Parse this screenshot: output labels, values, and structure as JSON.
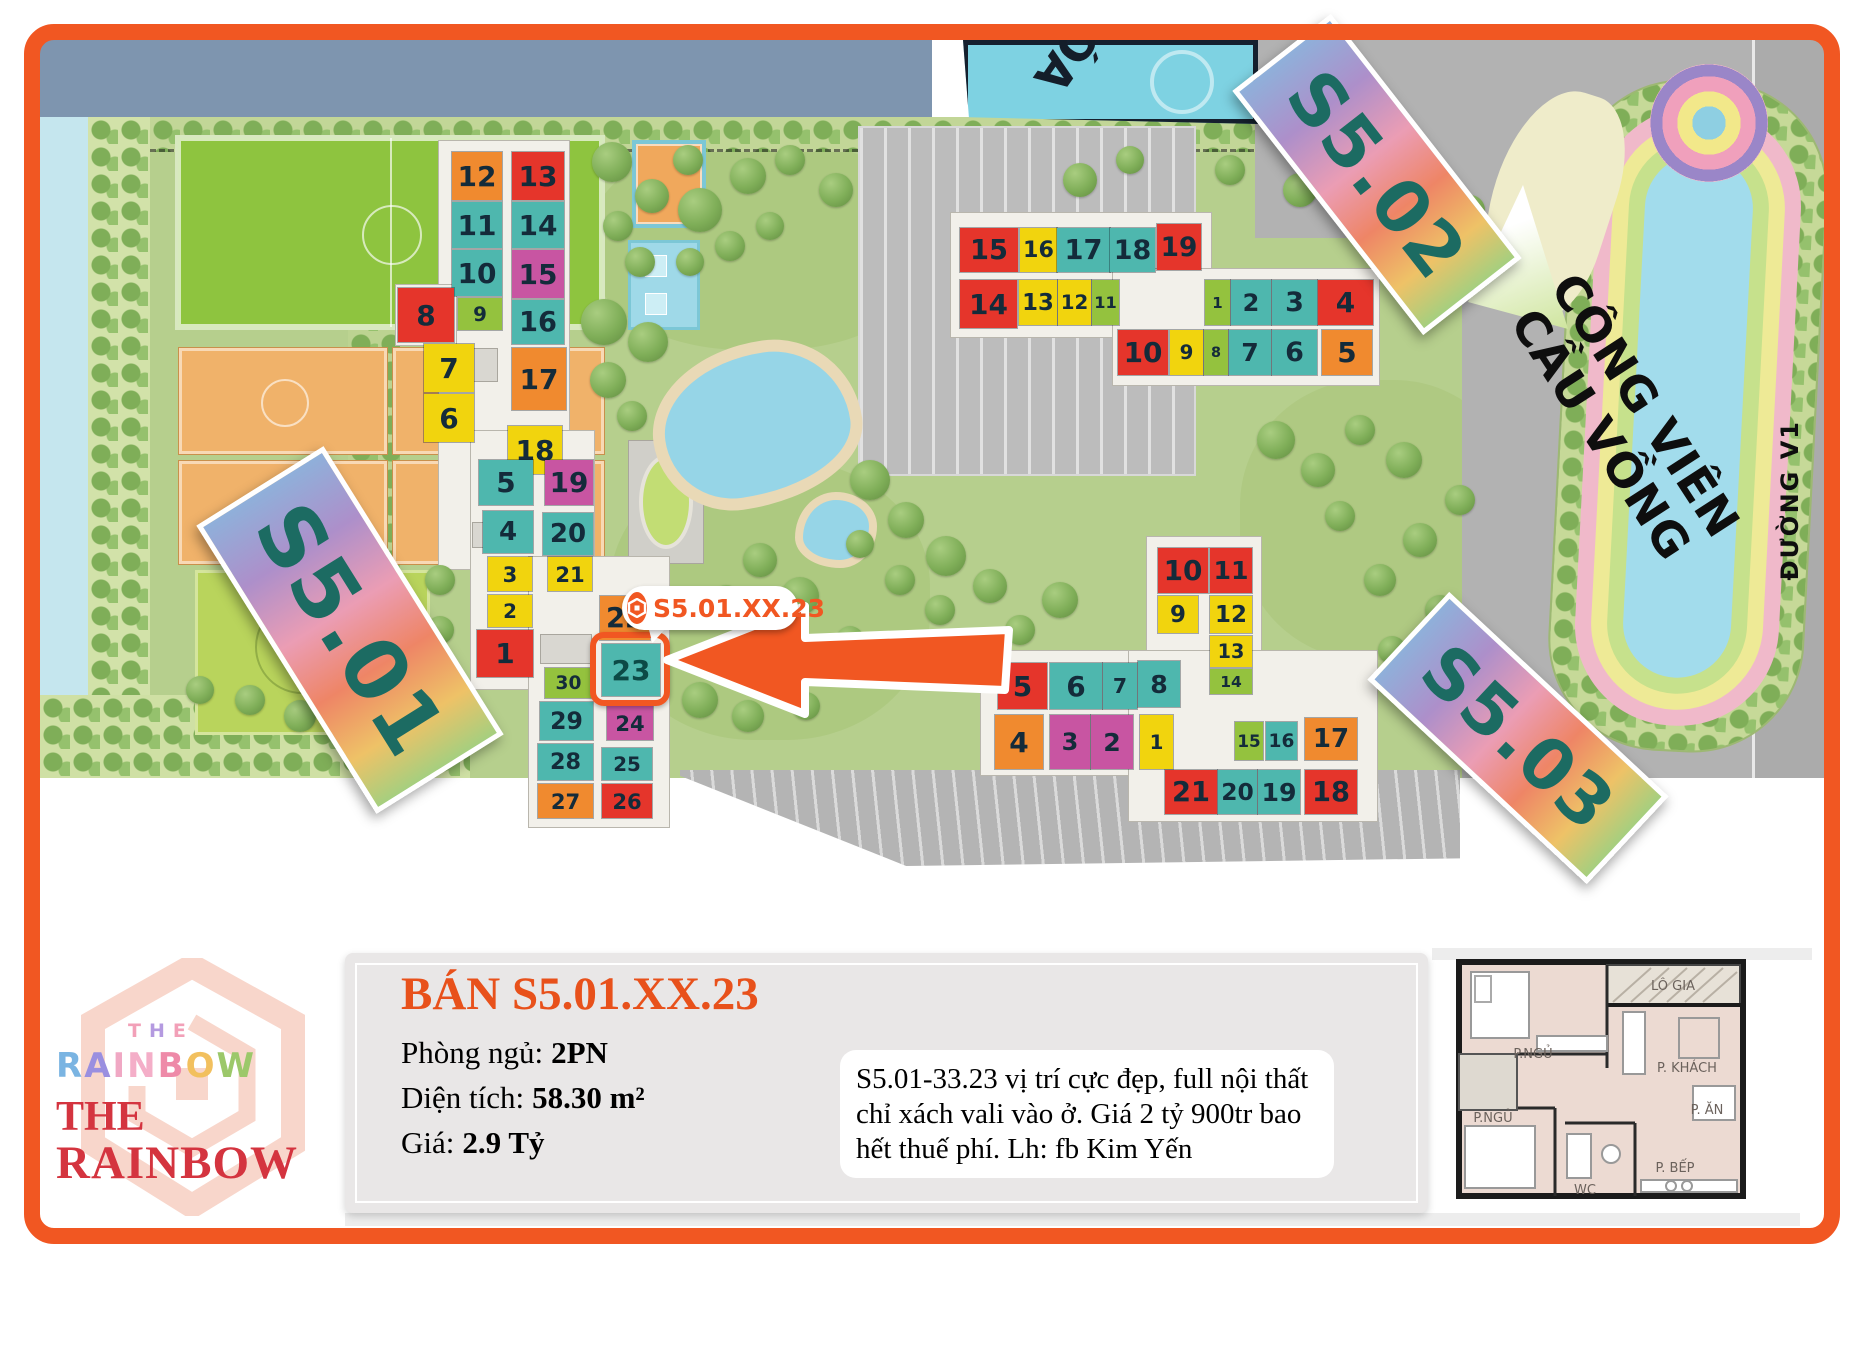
{
  "colors": {
    "frame": "#f15722",
    "accent_orange": "#f15722",
    "banner_text": "#1c6b62",
    "title_orange": "#e8511b",
    "logo_red": "#d4343f",
    "units": {
      "red": "#e5352b",
      "orange": "#f08a2f",
      "yellow": "#f1d40e",
      "teal": "#4eb7ae",
      "magenta": "#c855a2",
      "lime": "#94c23e"
    }
  },
  "map": {
    "school_label": "ÓA",
    "field_label": "33 T",
    "road_label": "ĐƯỜNG V1",
    "park_label_line1": "CÔNG VIÊN",
    "park_label_line2": "CẦU VỒNG",
    "callout": {
      "text": "S5.01.XX.23"
    },
    "selected_unit": {
      "n": 23,
      "x": 602,
      "y": 644,
      "w": 58,
      "h": 52,
      "c": "teal"
    },
    "buildings": {
      "s501": {
        "banner": "S5.01",
        "units": [
          {
            "n": 12,
            "x": 452,
            "y": 152,
            "w": 50,
            "h": 48,
            "c": "orange"
          },
          {
            "n": 13,
            "x": 512,
            "y": 152,
            "w": 52,
            "h": 48,
            "c": "red"
          },
          {
            "n": 11,
            "x": 452,
            "y": 202,
            "w": 50,
            "h": 46,
            "c": "teal"
          },
          {
            "n": 14,
            "x": 512,
            "y": 202,
            "w": 52,
            "h": 46,
            "c": "teal"
          },
          {
            "n": 10,
            "x": 452,
            "y": 250,
            "w": 50,
            "h": 46,
            "c": "teal"
          },
          {
            "n": 15,
            "x": 512,
            "y": 250,
            "w": 52,
            "h": 48,
            "c": "magenta"
          },
          {
            "n": 9,
            "x": 458,
            "y": 298,
            "w": 44,
            "h": 32,
            "c": "lime"
          },
          {
            "n": 16,
            "x": 512,
            "y": 300,
            "w": 52,
            "h": 44,
            "c": "teal"
          },
          {
            "n": 8,
            "x": 398,
            "y": 288,
            "w": 56,
            "h": 54,
            "c": "red"
          },
          {
            "n": 17,
            "x": 512,
            "y": 348,
            "w": 54,
            "h": 62,
            "c": "orange"
          },
          {
            "n": 7,
            "x": 424,
            "y": 344,
            "w": 50,
            "h": 48,
            "c": "yellow"
          },
          {
            "n": 6,
            "x": 424,
            "y": 394,
            "w": 50,
            "h": 48,
            "c": "yellow"
          },
          {
            "n": 18,
            "x": 508,
            "y": 426,
            "w": 54,
            "h": 48,
            "c": "yellow"
          },
          {
            "n": 5,
            "x": 479,
            "y": 460,
            "w": 54,
            "h": 45,
            "c": "teal"
          },
          {
            "n": 19,
            "x": 545,
            "y": 460,
            "w": 48,
            "h": 45,
            "c": "magenta"
          },
          {
            "n": 4,
            "x": 483,
            "y": 511,
            "w": 50,
            "h": 42,
            "c": "teal"
          },
          {
            "n": 20,
            "x": 543,
            "y": 513,
            "w": 50,
            "h": 42,
            "c": "teal"
          },
          {
            "n": 3,
            "x": 488,
            "y": 557,
            "w": 44,
            "h": 34,
            "c": "yellow"
          },
          {
            "n": 21,
            "x": 548,
            "y": 557,
            "w": 44,
            "h": 34,
            "c": "yellow"
          },
          {
            "n": 2,
            "x": 488,
            "y": 595,
            "w": 44,
            "h": 32,
            "c": "yellow"
          },
          {
            "n": 1,
            "x": 477,
            "y": 630,
            "w": 56,
            "h": 47,
            "c": "red"
          },
          {
            "n": 22,
            "x": 600,
            "y": 596,
            "w": 50,
            "h": 44,
            "c": "orange"
          },
          {
            "n": 30,
            "x": 545,
            "y": 668,
            "w": 47,
            "h": 30,
            "c": "lime"
          },
          {
            "n": 29,
            "x": 540,
            "y": 702,
            "w": 53,
            "h": 38,
            "c": "teal"
          },
          {
            "n": 24,
            "x": 607,
            "y": 706,
            "w": 46,
            "h": 34,
            "c": "magenta"
          },
          {
            "n": 28,
            "x": 538,
            "y": 744,
            "w": 55,
            "h": 36,
            "c": "teal"
          },
          {
            "n": 25,
            "x": 602,
            "y": 748,
            "w": 50,
            "h": 32,
            "c": "teal"
          },
          {
            "n": 27,
            "x": 538,
            "y": 784,
            "w": 55,
            "h": 34,
            "c": "orange"
          },
          {
            "n": 26,
            "x": 602,
            "y": 784,
            "w": 50,
            "h": 34,
            "c": "red"
          }
        ]
      },
      "s502": {
        "banner": "S5.02",
        "units": [
          {
            "n": 15,
            "x": 960,
            "y": 228,
            "w": 58,
            "h": 44,
            "c": "red"
          },
          {
            "n": 16,
            "x": 1020,
            "y": 228,
            "w": 37,
            "h": 44,
            "c": "yellow"
          },
          {
            "n": 17,
            "x": 1057,
            "y": 228,
            "w": 53,
            "h": 44,
            "c": "teal"
          },
          {
            "n": 18,
            "x": 1110,
            "y": 228,
            "w": 45,
            "h": 44,
            "c": "teal"
          },
          {
            "n": 19,
            "x": 1157,
            "y": 224,
            "w": 44,
            "h": 46,
            "c": "red"
          },
          {
            "n": 14,
            "x": 960,
            "y": 280,
            "w": 57,
            "h": 48,
            "c": "red"
          },
          {
            "n": 13,
            "x": 1019,
            "y": 280,
            "w": 38,
            "h": 45,
            "c": "yellow"
          },
          {
            "n": 12,
            "x": 1058,
            "y": 280,
            "w": 33,
            "h": 45,
            "c": "yellow"
          },
          {
            "n": 11,
            "x": 1092,
            "y": 280,
            "w": 27,
            "h": 45,
            "c": "lime"
          },
          {
            "n": 1,
            "x": 1205,
            "y": 280,
            "w": 25,
            "h": 45,
            "c": "lime"
          },
          {
            "n": 2,
            "x": 1231,
            "y": 280,
            "w": 40,
            "h": 45,
            "c": "teal"
          },
          {
            "n": 3,
            "x": 1272,
            "y": 280,
            "w": 45,
            "h": 45,
            "c": "teal"
          },
          {
            "n": 4,
            "x": 1318,
            "y": 280,
            "w": 55,
            "h": 45,
            "c": "red"
          },
          {
            "n": 10,
            "x": 1118,
            "y": 330,
            "w": 50,
            "h": 45,
            "c": "red"
          },
          {
            "n": 9,
            "x": 1170,
            "y": 330,
            "w": 33,
            "h": 45,
            "c": "yellow"
          },
          {
            "n": 8,
            "x": 1204,
            "y": 330,
            "w": 24,
            "h": 45,
            "c": "lime"
          },
          {
            "n": 7,
            "x": 1229,
            "y": 330,
            "w": 42,
            "h": 45,
            "c": "teal"
          },
          {
            "n": 6,
            "x": 1272,
            "y": 330,
            "w": 45,
            "h": 45,
            "c": "teal"
          },
          {
            "n": 5,
            "x": 1322,
            "y": 330,
            "w": 50,
            "h": 45,
            "c": "orange"
          }
        ]
      },
      "s503": {
        "banner": "S5.03",
        "units": [
          {
            "n": 10,
            "x": 1158,
            "y": 548,
            "w": 50,
            "h": 45,
            "c": "red"
          },
          {
            "n": 11,
            "x": 1210,
            "y": 548,
            "w": 42,
            "h": 45,
            "c": "red"
          },
          {
            "n": 9,
            "x": 1158,
            "y": 596,
            "w": 40,
            "h": 37,
            "c": "yellow"
          },
          {
            "n": 12,
            "x": 1210,
            "y": 596,
            "w": 42,
            "h": 37,
            "c": "yellow"
          },
          {
            "n": 13,
            "x": 1210,
            "y": 636,
            "w": 42,
            "h": 31,
            "c": "yellow"
          },
          {
            "n": 14,
            "x": 1210,
            "y": 669,
            "w": 42,
            "h": 25,
            "c": "lime"
          },
          {
            "n": 5,
            "x": 998,
            "y": 663,
            "w": 49,
            "h": 46,
            "c": "red"
          },
          {
            "n": 6,
            "x": 1050,
            "y": 663,
            "w": 52,
            "h": 46,
            "c": "teal"
          },
          {
            "n": 7,
            "x": 1103,
            "y": 663,
            "w": 34,
            "h": 46,
            "c": "teal"
          },
          {
            "n": 8,
            "x": 1138,
            "y": 661,
            "w": 42,
            "h": 46,
            "c": "teal"
          },
          {
            "n": 4,
            "x": 995,
            "y": 715,
            "w": 48,
            "h": 54,
            "c": "orange"
          },
          {
            "n": 3,
            "x": 1050,
            "y": 715,
            "w": 40,
            "h": 54,
            "c": "magenta"
          },
          {
            "n": 2,
            "x": 1091,
            "y": 715,
            "w": 42,
            "h": 54,
            "c": "magenta"
          },
          {
            "n": 1,
            "x": 1140,
            "y": 715,
            "w": 33,
            "h": 54,
            "c": "yellow"
          },
          {
            "n": 15,
            "x": 1235,
            "y": 722,
            "w": 28,
            "h": 38,
            "c": "lime"
          },
          {
            "n": 16,
            "x": 1266,
            "y": 722,
            "w": 31,
            "h": 38,
            "c": "teal"
          },
          {
            "n": 17,
            "x": 1305,
            "y": 718,
            "w": 52,
            "h": 42,
            "c": "orange"
          },
          {
            "n": 21,
            "x": 1165,
            "y": 770,
            "w": 52,
            "h": 44,
            "c": "red"
          },
          {
            "n": 20,
            "x": 1218,
            "y": 770,
            "w": 39,
            "h": 44,
            "c": "teal"
          },
          {
            "n": 19,
            "x": 1258,
            "y": 770,
            "w": 42,
            "h": 44,
            "c": "teal"
          },
          {
            "n": 18,
            "x": 1305,
            "y": 770,
            "w": 52,
            "h": 44,
            "c": "red"
          }
        ]
      }
    }
  },
  "logo": {
    "the_small_letters": [
      {
        "ch": "T",
        "color": "#f2a0b8"
      },
      {
        "ch": "H",
        "color": "#b49ae0"
      },
      {
        "ch": "E",
        "color": "#f2a0b8"
      }
    ],
    "rainbow_letters": [
      {
        "ch": "R",
        "color": "#7ab4e2"
      },
      {
        "ch": "A",
        "color": "#9a8fe0"
      },
      {
        "ch": "I",
        "color": "#f0a8c4"
      },
      {
        "ch": "N",
        "color": "#f4aec8"
      },
      {
        "ch": "B",
        "color": "#ee8aa8"
      },
      {
        "ch": "O",
        "color": "#f2c05e"
      },
      {
        "ch": "W",
        "color": "#9cc86a"
      }
    ],
    "the_big": "THE",
    "rainbow_big": "RAINBOW"
  },
  "panel": {
    "title": "BÁN S5.01.XX.23",
    "specs": [
      {
        "label": "Phòng ngủ:",
        "value": "2PN"
      },
      {
        "label": "Diện tích:",
        "value": "58.30 m²"
      },
      {
        "label": "Giá:",
        "value": "2.9 Tỷ"
      }
    ],
    "description": "S5.01-33.23 vị trí cực đẹp, full nội thất chỉ xách vali vào ở. Giá 2 tỷ 900tr bao hết thuế phí. Lh: fb Kim Yến"
  },
  "floorplan": {
    "rooms": [
      "P.NGỦ",
      "LÔ GIA",
      "P. KHÁCH",
      "P. ĂN",
      "P.NGỦ",
      "WC",
      "P. BẾP"
    ]
  }
}
